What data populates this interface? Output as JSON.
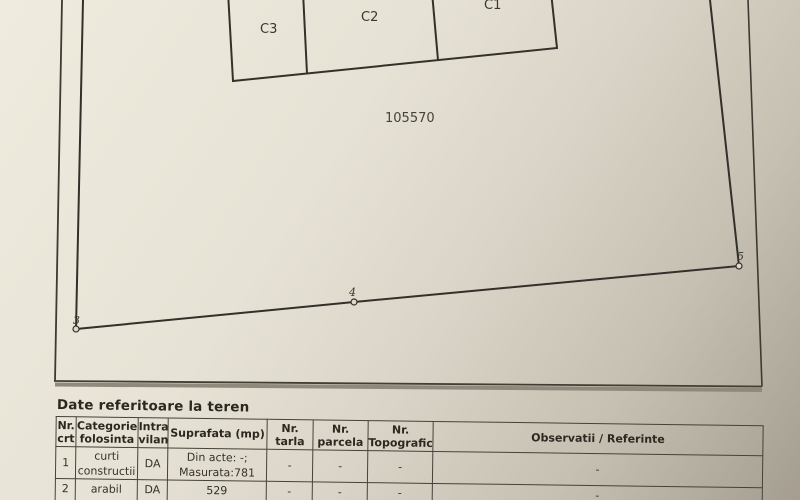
{
  "photo": {
    "paper_light": "#efecdf",
    "paper_dark": "#a49d90",
    "ink": "#35322a"
  },
  "plan": {
    "parcel_number": "105570",
    "building_labels": [
      "C3",
      "C2",
      "C1"
    ],
    "boundary_point_labels": [
      "3",
      "4",
      "5"
    ]
  },
  "terrain_table": {
    "title": "Date referitoare la teren",
    "headers": [
      {
        "l1": "Nr.",
        "l2": "crt"
      },
      {
        "l1": "Categorie",
        "l2": "folosinta"
      },
      {
        "l1": "Intra",
        "l2": "vilan"
      },
      {
        "l1": "Suprafata (mp)",
        "l2": ""
      },
      {
        "l1": "Nr.",
        "l2": "tarla"
      },
      {
        "l1": "Nr.",
        "l2": "parcela"
      },
      {
        "l1": "Nr.",
        "l2": "Topografic"
      },
      {
        "l1": "Observatii / Referinte",
        "l2": ""
      }
    ],
    "rows": [
      {
        "nr": "1",
        "categorie_l1": "curti",
        "categorie_l2": "constructii",
        "intravilan": "DA",
        "suprafata_l1": "Din acte: -;",
        "suprafata_l2": "Masurata:781",
        "tarla": "-",
        "parcela": "-",
        "topografic": "-",
        "observatii": "-"
      },
      {
        "nr": "2",
        "categorie_l1": "arabil",
        "categorie_l2": "",
        "intravilan": "DA",
        "suprafata_l1": "529",
        "suprafata_l2": "",
        "tarla": "-",
        "parcela": "-",
        "topografic": "-",
        "observatii": "-"
      }
    ]
  }
}
